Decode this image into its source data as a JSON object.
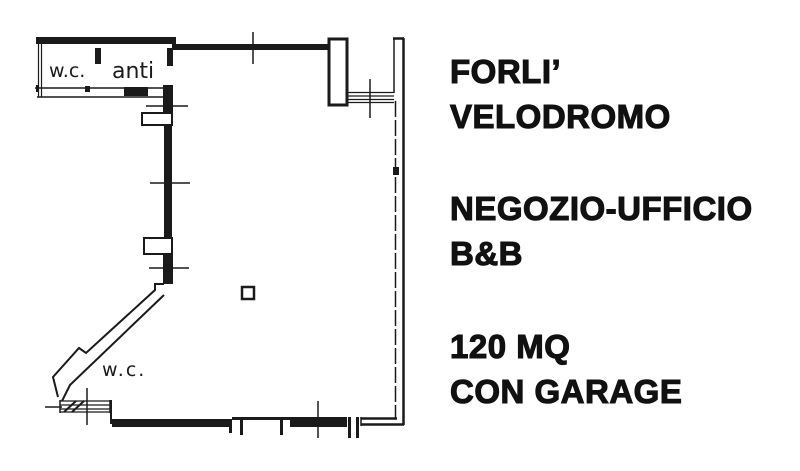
{
  "plan": {
    "labels": {
      "wc_top": "w.c.",
      "anteroom": "anti",
      "wc_bottom": "w.c."
    }
  },
  "caption": {
    "location_line1": "FORLI’",
    "location_line2": "VELODROMO",
    "type_line1": "NEGOZIO-UFFICIO",
    "type_line2": "B&B",
    "size_line1": "120 MQ",
    "size_line2": "CON GARAGE"
  },
  "colors": {
    "ink": "#1a1a1a",
    "paper": "#ffffff"
  }
}
